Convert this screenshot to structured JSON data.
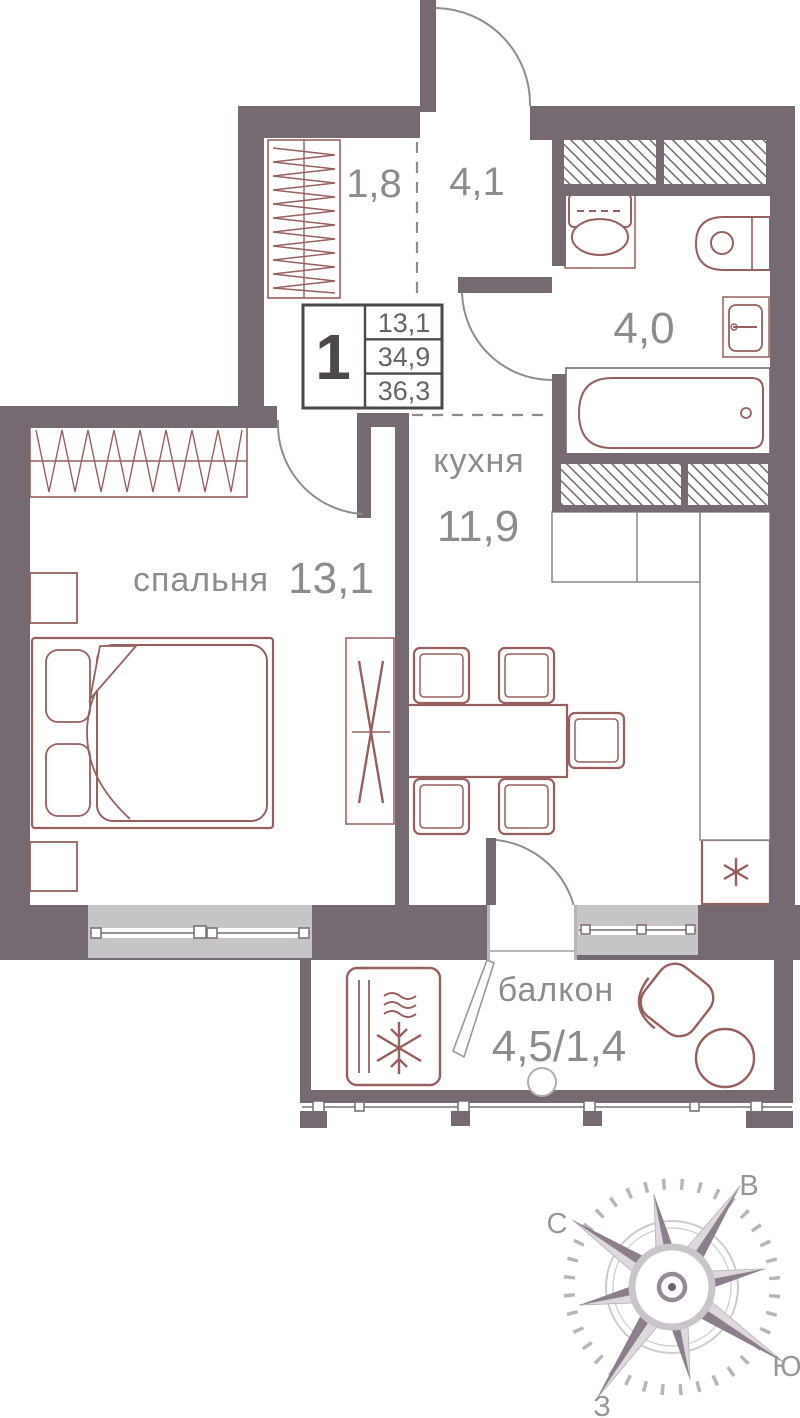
{
  "unit_card": {
    "rooms_count": "1",
    "living_area": "13,1",
    "apartment_area": "34,9",
    "total_area": "36,3"
  },
  "rooms": {
    "hall": {
      "area": "1,8"
    },
    "corridor": {
      "area": "4,1"
    },
    "bathroom": {
      "area": "4,0"
    },
    "kitchen": {
      "name": "кухня",
      "area": "11,9"
    },
    "bedroom": {
      "name": "спальня",
      "area": "13,1"
    },
    "balcony": {
      "name": "балкон",
      "area": "4,5/1,4"
    }
  },
  "compass": {
    "north": "С",
    "east": "В",
    "south": "Ю",
    "west": "З"
  },
  "colors": {
    "wall": "#756a71",
    "furniture": "#96605f",
    "counter_line": "#8f8f93",
    "label_text": "#8e8b90",
    "card_number": "#66646a",
    "card_big_number": "#4c474b",
    "window_sill": "#c7c4c7",
    "compass_light": "#dcd8dc",
    "compass_dark": "#8b7f8c"
  }
}
